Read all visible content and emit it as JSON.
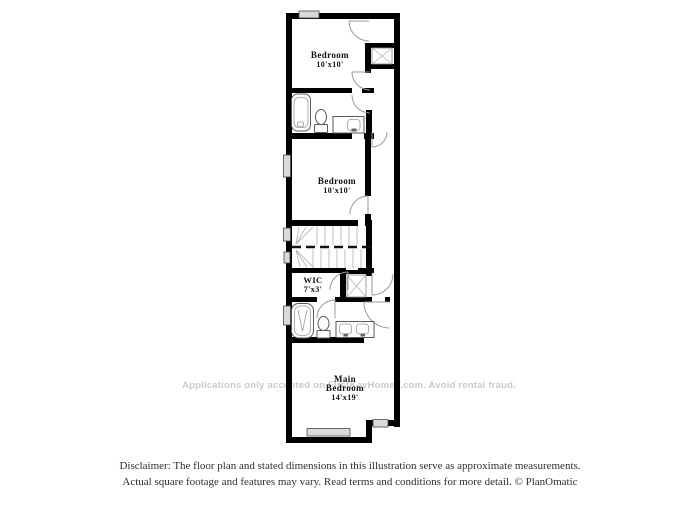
{
  "floor_plan": {
    "rooms": [
      {
        "id": "bedroom-upper",
        "name": "Bedroom",
        "dims": "10'x10'"
      },
      {
        "id": "bedroom-middle",
        "name": "Bedroom",
        "dims": "10'x10'"
      },
      {
        "id": "wic",
        "name": "WIC",
        "dims": "7'x3'"
      },
      {
        "id": "main-bedroom",
        "name": "Main",
        "name2": "Bedroom",
        "dims": "14'x19'"
      }
    ],
    "fixtures": [
      "bathtub",
      "toilet",
      "sink-vanity",
      "shower-tub",
      "toilet",
      "double-sink-vanity",
      "closet-shelving-upper",
      "closet-shelving-wic",
      "staircase"
    ],
    "colors": {
      "wall": "#000000",
      "window_fill": "#d9d9d9",
      "door_arc": "#9a9a9a",
      "stair_line": "#b8b8b8",
      "label": "#111111"
    }
  },
  "watermark": {
    "text": "Applications only accepted on FirstKeyHomes.com. Avoid rental fraud.",
    "color": "#cacaca"
  },
  "disclaimer": {
    "line1": "Disclaimer: The floor plan and stated dimensions in this illustration serve as approximate measurements.",
    "line2": "Actual square footage and features may vary. Read terms and conditions for more detail. © PlanOmatic",
    "color": "#2e2e2e"
  }
}
